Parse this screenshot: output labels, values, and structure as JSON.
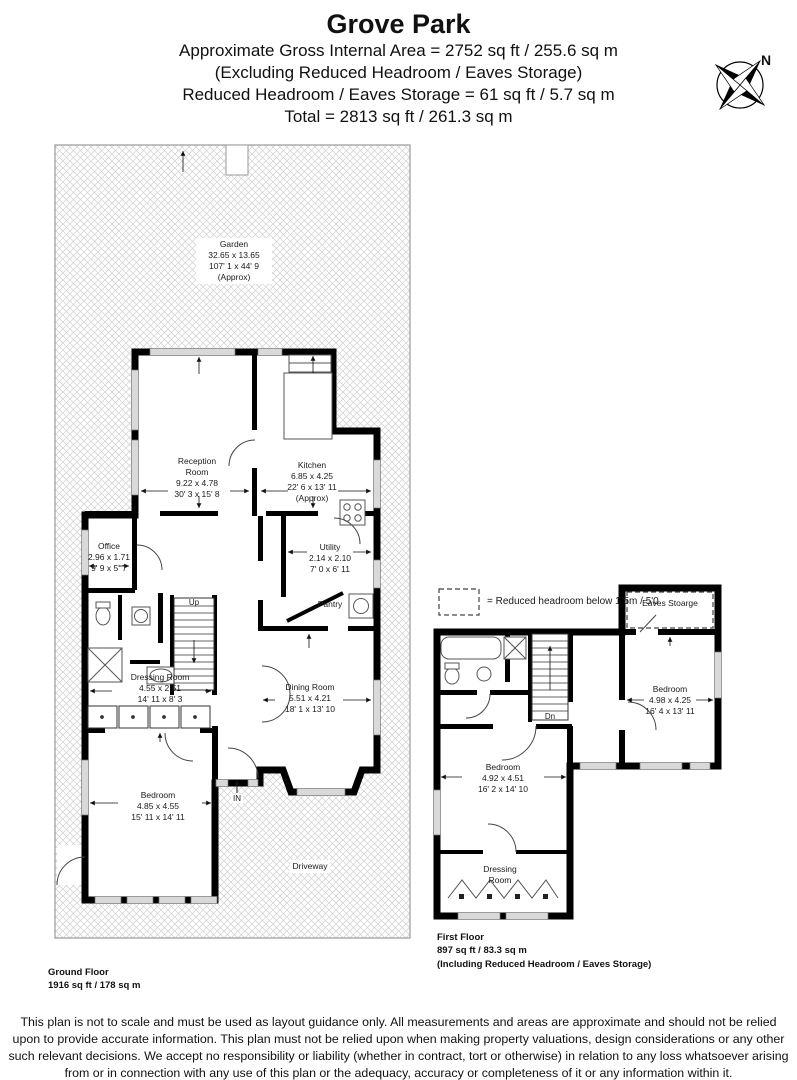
{
  "header": {
    "title": "Grove Park",
    "line1": "Approximate Gross Internal Area = 2752 sq ft / 255.6 sq m",
    "line2": "(Excluding Reduced Headroom / Eaves Storage)",
    "line3": "Reduced Headroom / Eaves Storage = 61 sq ft / 5.7 sq m",
    "line4": "Total = 2813 sq ft / 261.3 sq m"
  },
  "compass": {
    "label": "N"
  },
  "legend": {
    "text": "= Reduced headroom below 1.5m / 5'0"
  },
  "ground_floor": {
    "label": "Ground Floor",
    "area": "1916 sq ft / 178 sq m",
    "garden": {
      "name": "Garden",
      "metric": "32.65 x 13.65",
      "imperial": "107' 1 x 44' 9",
      "approx": "(Approx)"
    },
    "driveway": {
      "name": "Driveway"
    },
    "rooms": {
      "reception": {
        "name": "Reception Room",
        "metric": "9.22 x 4.78",
        "imperial": "30' 3 x 15' 8"
      },
      "kitchen": {
        "name": "Kitchen",
        "metric": "6.85 x 4.25",
        "imperial": "22' 6 x 13' 11",
        "approx": "(Approx)"
      },
      "office": {
        "name": "Office",
        "metric": "2.96 x 1.71",
        "imperial": "9' 9 x 5' 7"
      },
      "utility": {
        "name": "Utility",
        "metric": "2.14 x 2.10",
        "imperial": "7' 0 x 6' 11"
      },
      "pantry": {
        "name": "Pantry"
      },
      "dining": {
        "name": "Dining Room",
        "metric": "5.51 x 4.21",
        "imperial": "18' 1 x 13' 10"
      },
      "dressing": {
        "name": "Dressing Room",
        "metric": "4.55 x 2.51",
        "imperial": "14' 11 x 8' 3"
      },
      "bedroom": {
        "name": "Bedroom",
        "metric": "4.85 x 4.55",
        "imperial": "15' 11 x 14' 11"
      }
    },
    "stairs_label": "Up",
    "entrance_label": "IN"
  },
  "first_floor": {
    "label": "First Floor",
    "area": "897 sq ft / 83.3 sq m",
    "note": "(Including Reduced Headroom / Eaves Storage)",
    "rooms": {
      "eaves_storage": {
        "name": "Eaves Stoarge"
      },
      "bedroom_right": {
        "name": "Bedroom",
        "metric": "4.98 x 4.25",
        "imperial": "16' 4 x 13' 11"
      },
      "bedroom_left": {
        "name": "Bedroom",
        "metric": "4.92 x 4.51",
        "imperial": "16' 2 x 14' 10"
      },
      "dressing": {
        "name": "Dressing Room"
      }
    },
    "stairs_label": "Dn"
  },
  "disclaimer": "This plan is not to scale and must be used as layout guidance only. All measurements and areas are approximate and should not be relied upon to provide accurate information. This plan must not be relied upon when making property valuations, design considerations or any other such relevant decisions. We accept no responsibility or liability (whether in contract, tort or otherwise) in relation to any loss whatsoever arising from or in connection with any use of this plan or the adequacy, accuracy or completeness of it or any information within it."
}
